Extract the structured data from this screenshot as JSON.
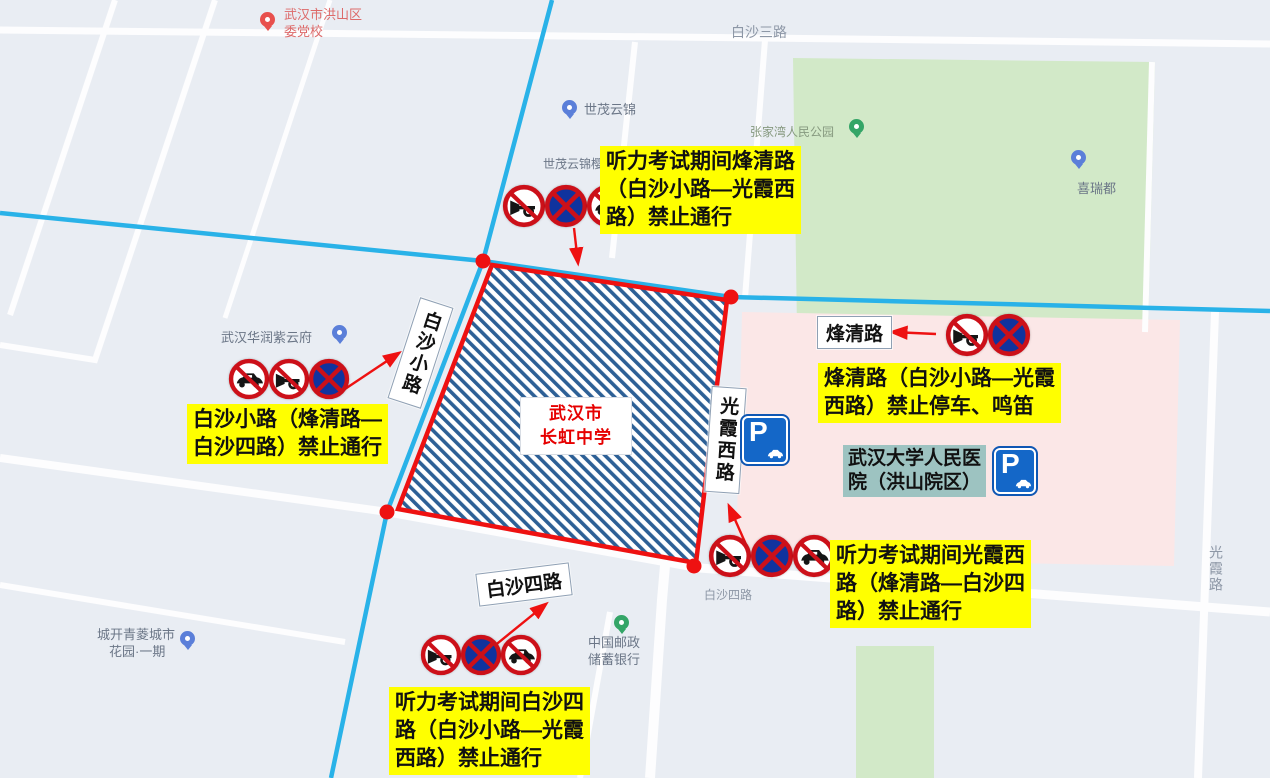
{
  "roads_gray": {
    "baisha3": "白沙三路",
    "baisha4_small": "白沙四路",
    "guangxia": "光霞路"
  },
  "road_boxes": {
    "fengqing": "烽清路",
    "baisha_xiao": "白沙小路",
    "guangxia_xi": "光霞西路",
    "baisha_si": "白沙四路"
  },
  "school": {
    "line1": "武汉市",
    "line2": "长虹中学"
  },
  "hospital": {
    "line1": "武汉大学人民医",
    "line2": "院（洪山院区）"
  },
  "parking": {
    "letter": "P"
  },
  "pois": {
    "party_school": {
      "line1": "武汉市洪山区",
      "line2": "委党校"
    },
    "shimao": "世茂云锦",
    "shimao_yinghai": "世茂云锦樱海园",
    "zhangjiawan_park": "张家湾人民公园",
    "xiruidu": "喜瑞都",
    "huarun": "武汉华润紫云府",
    "postal_bank": {
      "line1": "中国邮政",
      "line2": "储蓄银行"
    },
    "chengkai": {
      "line1": "城开青菱城市",
      "line2": "花园·一期"
    }
  },
  "annotations": {
    "fengqing_closed": {
      "lines": [
        "听力考试期间烽清路",
        "（白沙小路—光霞西",
        "路）禁止通行"
      ]
    },
    "fengqing_noparking": {
      "lines": [
        "烽清路（白沙小路—光霞",
        "西路）禁止停车、鸣笛"
      ]
    },
    "baisha_xiao_closed": {
      "lines": [
        "白沙小路（烽清路—",
        "白沙四路）禁止通行"
      ]
    },
    "guangxia_closed": {
      "lines": [
        "听力考试期间光霞西",
        "路（烽清路—白沙四",
        "路）禁止通行"
      ]
    },
    "baisha_si_closed": {
      "lines": [
        "听力考试期间白沙四",
        "路（白沙小路—光霞",
        "西路）禁止通行"
      ]
    }
  },
  "colors": {
    "annotation_bg": "#ffff00",
    "route_red": "#ee1111",
    "road_cyan": "#29b2e8",
    "hatch_blue": "#2d6096",
    "hospital_bg": "#9dc3c1",
    "park_green": "#d2e9c8",
    "pink_zone": "#fbe7e7",
    "sign_red": "#cc1019",
    "sign_blue": "#10339e",
    "parking_blue": "#1467c8"
  }
}
